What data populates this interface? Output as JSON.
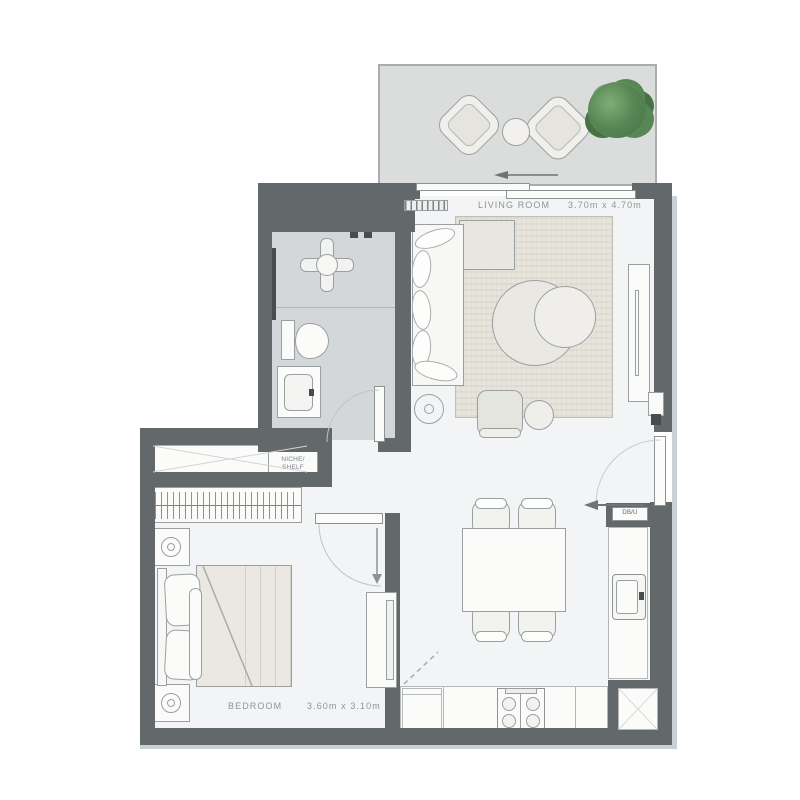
{
  "document": {
    "type": "apartment-floor-plan"
  },
  "colors": {
    "wall": "#63686a",
    "floor": "#f3f4f5",
    "bathroom_floor": "#d4d7d9",
    "balcony_floor": "#dadddc",
    "rug": "#e7e4dc",
    "mattress": "#eae8e1",
    "furniture_fill": "#fbfbfa",
    "furniture_line": "#9aa0a0",
    "accent_fill": "#e7e6e1",
    "dark_fixture": "#474c4e",
    "text": "#8f9497",
    "trim": "#c6d2d4",
    "tree_dark": "#467244",
    "tree_mid": "#588756",
    "tree_light": "#7fae77"
  },
  "rooms": {
    "living_room": {
      "label": "LIVING ROOM",
      "dimensions": "3.70m x 4.70m"
    },
    "bedroom": {
      "label": "BEDROOM",
      "dimensions": "3.60m x 3.10m"
    },
    "niche": {
      "line1": "NICHE/",
      "line2": "SHELF"
    },
    "utility": {
      "label": "DB/U"
    }
  },
  "fixtures": [
    "balcony-lounge-chair",
    "balcony-round-table",
    "tree",
    "sliding-door",
    "sofa",
    "rug",
    "coffee-table",
    "floor-lamp",
    "armchair",
    "side-table",
    "tv-cabinet",
    "shower",
    "toilet",
    "vanity-sink",
    "bathroom-door",
    "closet",
    "niche-shelf",
    "wardrobe-hangers",
    "nightstand",
    "table-lamp",
    "double-bed",
    "bedroom-door",
    "tall-cabinet",
    "dining-table",
    "dining-chair",
    "kitchen-counter",
    "kitchen-sink",
    "cooktop",
    "entrance-door",
    "entry-arrow",
    "service-shaft"
  ]
}
